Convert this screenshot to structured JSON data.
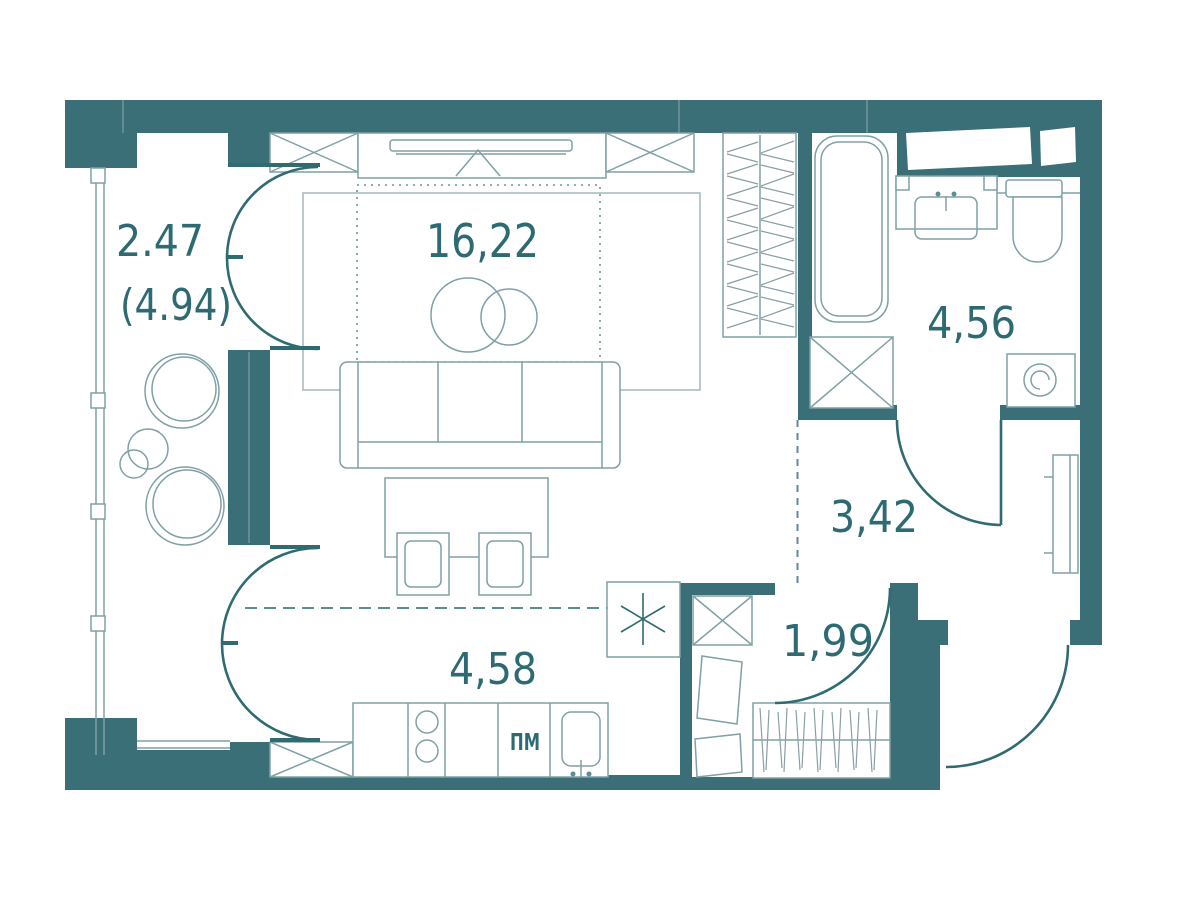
{
  "title": "Studio apartment floor plan",
  "colors": {
    "wall": "#3A6F77",
    "wall_dark": "#2F6B70",
    "furniture_line": "#7FA0A6",
    "label_text": "#2D6A72",
    "background": "#FFFFFF"
  },
  "rooms": [
    {
      "id": "balcony",
      "area": "2.47",
      "area_total": "(4.94)"
    },
    {
      "id": "living-room",
      "area": "16,22"
    },
    {
      "id": "bathroom",
      "area": "4,56"
    },
    {
      "id": "hallway",
      "area": "3,42"
    },
    {
      "id": "kitchen",
      "area": "4,58"
    },
    {
      "id": "entry-closet",
      "area": "1,99"
    }
  ],
  "labels": {
    "dishwasher": "ПМ"
  }
}
